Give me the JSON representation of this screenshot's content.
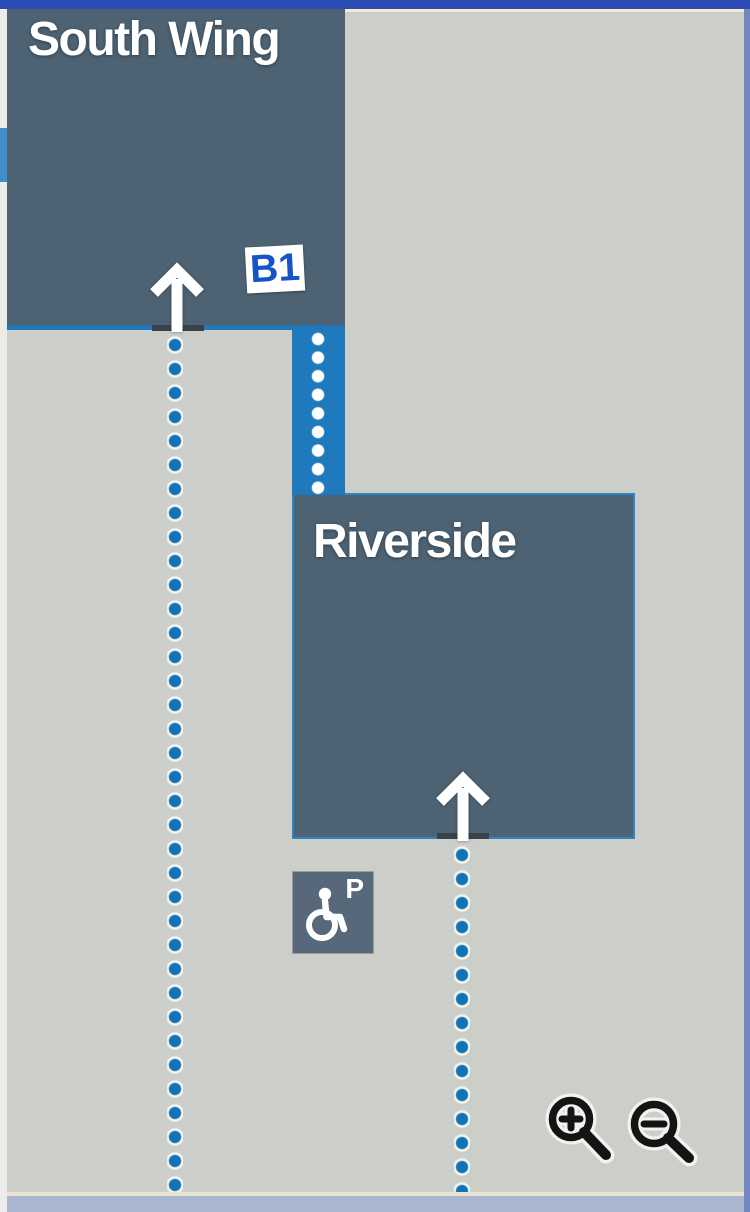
{
  "page": {
    "type": "campus-map-viewer"
  },
  "colors": {
    "background": "#cbcec9",
    "building_fill": "#4d6272",
    "corridor_blue": "#1e7abd",
    "path_dot_blue": "#1173b8",
    "map_border_top": "#2b4db5",
    "map_border_right": "#7088c1",
    "bottom_strip": "#a9b6cf",
    "badge_text_blue": "#1553c8",
    "label_text": "#ffffff"
  },
  "buildings": {
    "south_wing": {
      "label": "South Wing",
      "level_badge": "B1"
    },
    "riverside": {
      "label": "Riverside"
    }
  },
  "markers": {
    "accessible_parking": {
      "letter": "P",
      "icon": "wheelchair-icon"
    }
  },
  "paths": {
    "style": "blue-dotted",
    "entrance_arrows": 2
  },
  "controls": {
    "zoom_in_label": "zoom in",
    "zoom_out_label": "zoom out"
  }
}
